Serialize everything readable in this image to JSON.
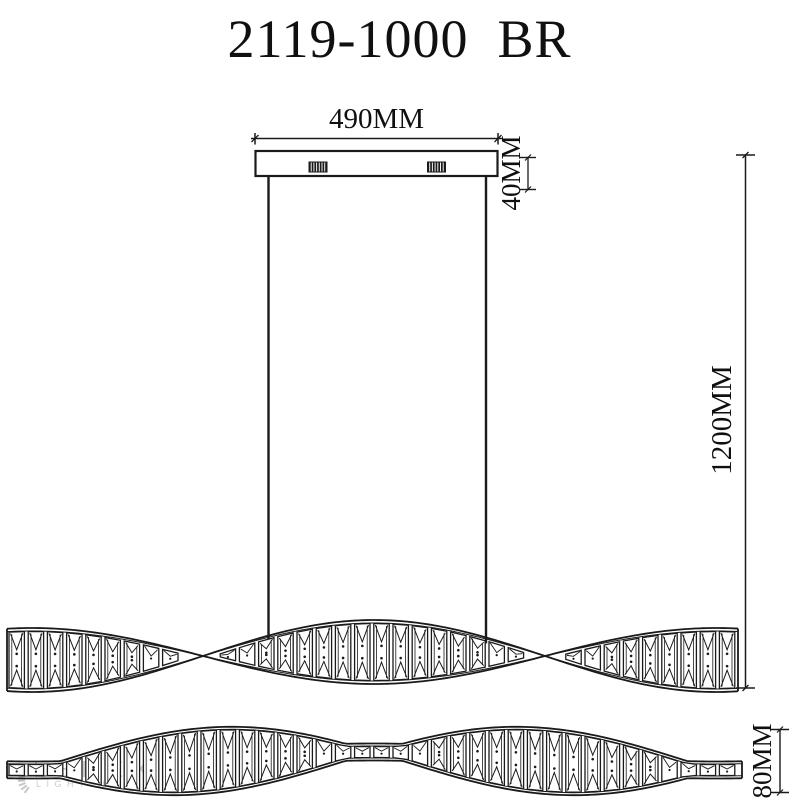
{
  "title": "2119-1000  BR",
  "dimensions": {
    "canopy_width": "490MM",
    "canopy_height": "40MM",
    "suspension_drop": "1200MM",
    "body_height": "80MM"
  },
  "watermark": {
    "brand": "LEDEX",
    "tagline": "LIGHTING"
  },
  "colors": {
    "line": "#1a1a1a",
    "background": "#ffffff",
    "watermark": "#c7c7c7"
  }
}
